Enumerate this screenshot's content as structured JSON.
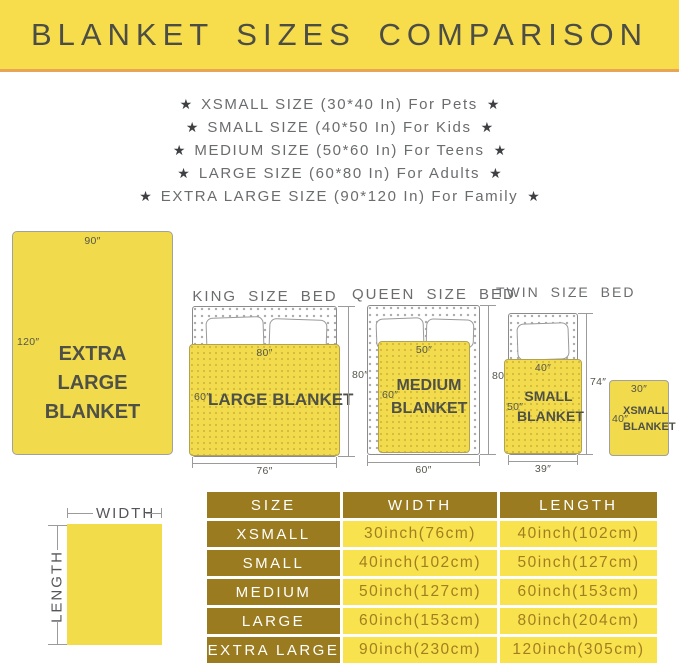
{
  "title": "BLANKET SIZES COMPARISON",
  "star": "★",
  "size_list": [
    "XSMALL SIZE (30*40 In) For Pets",
    "SMALL SIZE (40*50 In) For Kids",
    "MEDIUM SIZE (50*60 In) For Teens",
    "LARGE SIZE (60*80 In) For Adults",
    "EXTRA LARGE SIZE (90*120 In) For Family"
  ],
  "diagrams": {
    "xl": {
      "label": "EXTRA LARGE BLANKET",
      "top": "90″",
      "side": "120″"
    },
    "king": {
      "bed_title": "KING SIZE BED",
      "blanket_label": "LARGE BLANKET",
      "blanket_top": "80″",
      "blanket_side": "60″",
      "bed_height": "80″",
      "bed_width": "76″"
    },
    "queen": {
      "bed_title": "QUEEN SIZE BED",
      "blanket_label": "MEDIUM BLANKET",
      "blanket_top": "50″",
      "blanket_side": "60″",
      "bed_height": "80″",
      "bed_width": "60″"
    },
    "twin": {
      "bed_title": "TWIN SIZE BED",
      "blanket_label": "SMALL BLANKET",
      "blanket_top": "40″",
      "blanket_side": "50″",
      "bed_height": "74″",
      "bed_width": "39″"
    },
    "xsmall": {
      "label": "XSMALL BLANKET",
      "top": "30″",
      "side": "40″"
    }
  },
  "measure": {
    "width_label": "WIDTH",
    "length_label": "LENGTH"
  },
  "table": {
    "headers": [
      "SIZE",
      "WIDTH",
      "LENGTH"
    ],
    "rows": [
      {
        "size": "XSMALL",
        "width": "30inch(76cm)",
        "length": "40inch(102cm)"
      },
      {
        "size": "SMALL",
        "width": "40inch(102cm)",
        "length": "50inch(127cm)"
      },
      {
        "size": "MEDIUM",
        "width": "50inch(127cm)",
        "length": "60inch(153cm)"
      },
      {
        "size": "LARGE",
        "width": "60inch(153cm)",
        "length": "80inch(204cm)"
      },
      {
        "size": "EXTRA LARGE",
        "width": "90inch(230cm)",
        "length": "120inch(305cm)"
      }
    ]
  },
  "colors": {
    "banner_yellow": "#F7DD4C",
    "accent_orange": "#E9A556",
    "blanket_yellow": "#F2DC4D",
    "table_gold": "#9A7B1F",
    "table_cell_yellow": "#F8E24E",
    "text_gray": "#6B6C6E",
    "text_dark": "#4F5046"
  }
}
